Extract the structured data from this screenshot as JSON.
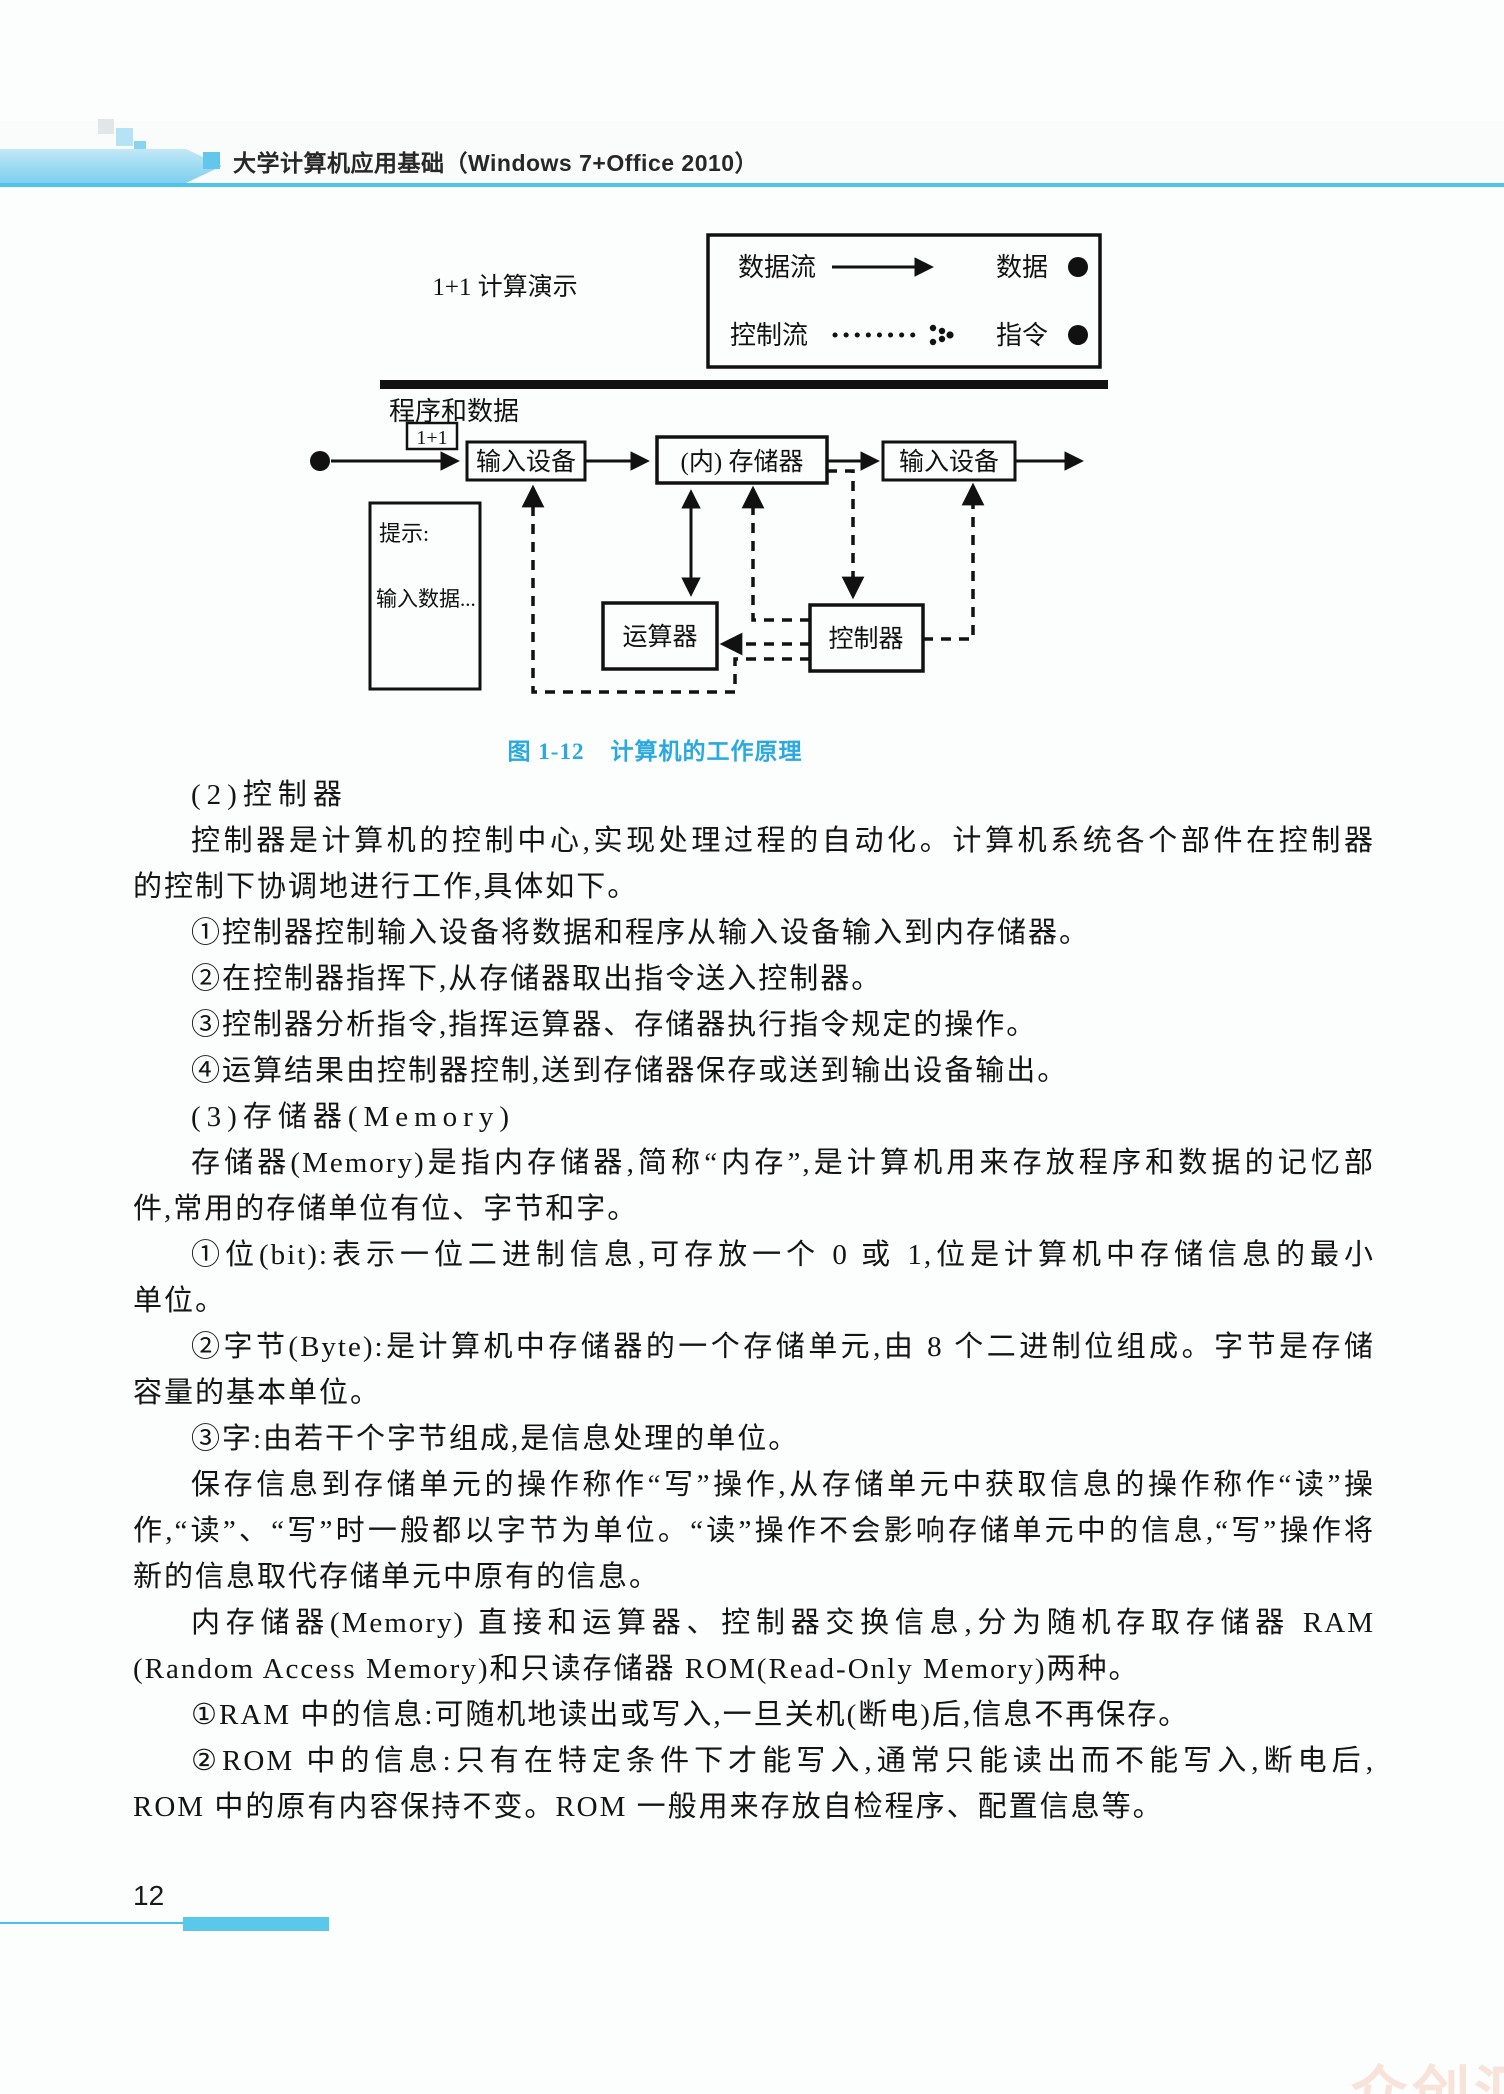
{
  "header": {
    "title": "大学计算机应用基础（Windows 7+Office 2010）"
  },
  "figure": {
    "demo_label": "1+1 计算演示",
    "program_data_label": "程序和数据",
    "input_tag": "1+1",
    "legend": {
      "data_flow": "数据流",
      "data": "数据",
      "control_flow": "控制流",
      "instruction": "指令"
    },
    "boxes": {
      "input_device": "输入设备",
      "memory": "(内) 存储器",
      "output_device": "输入设备",
      "alu": "运算器",
      "control_unit": "控制器"
    },
    "hint": {
      "title": "提示:",
      "text": "输入数据..."
    },
    "caption_label": "图 1-12",
    "caption_title": "计算机的工作原理"
  },
  "body": {
    "lines": [
      "(2)控制器",
      "控制器是计算机的控制中心,实现处理过程的自动化。计算机系统各个部件在控制器",
      "的控制下协调地进行工作,具体如下。",
      "①控制器控制输入设备将数据和程序从输入设备输入到内存储器。",
      "②在控制器指挥下,从存储器取出指令送入控制器。",
      "③控制器分析指令,指挥运算器、存储器执行指令规定的操作。",
      "④运算结果由控制器控制,送到存储器保存或送到输出设备输出。",
      "(3)存储器(Memory)",
      "存储器(Memory)是指内存储器,简称“内存”,是计算机用来存放程序和数据的记忆部",
      "件,常用的存储单位有位、字节和字。",
      "①位(bit):表示一位二进制信息,可存放一个 0 或 1,位是计算机中存储信息的最小",
      "单位。",
      "②字节(Byte):是计算机中存储器的一个存储单元,由 8 个二进制位组成。字节是存储",
      "容量的基本单位。",
      "③字:由若干个字节组成,是信息处理的单位。",
      "保存信息到存储单元的操作称作“写”操作,从存储单元中获取信息的操作称作“读”操",
      "作,“读”、“写”时一般都以字节为单位。“读”操作不会影响存储单元中的信息,“写”操作将",
      "新的信息取代存储单元中原有的信息。",
      "内存储器(Memory) 直接和运算器、控制器交换信息,分为随机存取存储器 RAM",
      "(Random Access Memory)和只读存储器 ROM(Read-Only Memory)两种。",
      "①RAM 中的信息:可随机地读出或写入,一旦关机(断电)后,信息不再保存。",
      "②ROM 中的信息:只有在特定条件下才能写入,通常只能读出而不能写入,断电后,",
      "ROM 中的原有内容保持不变。ROM 一般用来存放自检程序、配置信息等。"
    ]
  },
  "footer": {
    "page_number": "12"
  },
  "watermark": {
    "text": "众创汇嘉"
  },
  "colors": {
    "accent_blue": "#4fc4e9",
    "caption_blue": "#2aa9e0",
    "bar_blue": "#5ac8ea",
    "watermark_pink": "#f8e3da"
  }
}
